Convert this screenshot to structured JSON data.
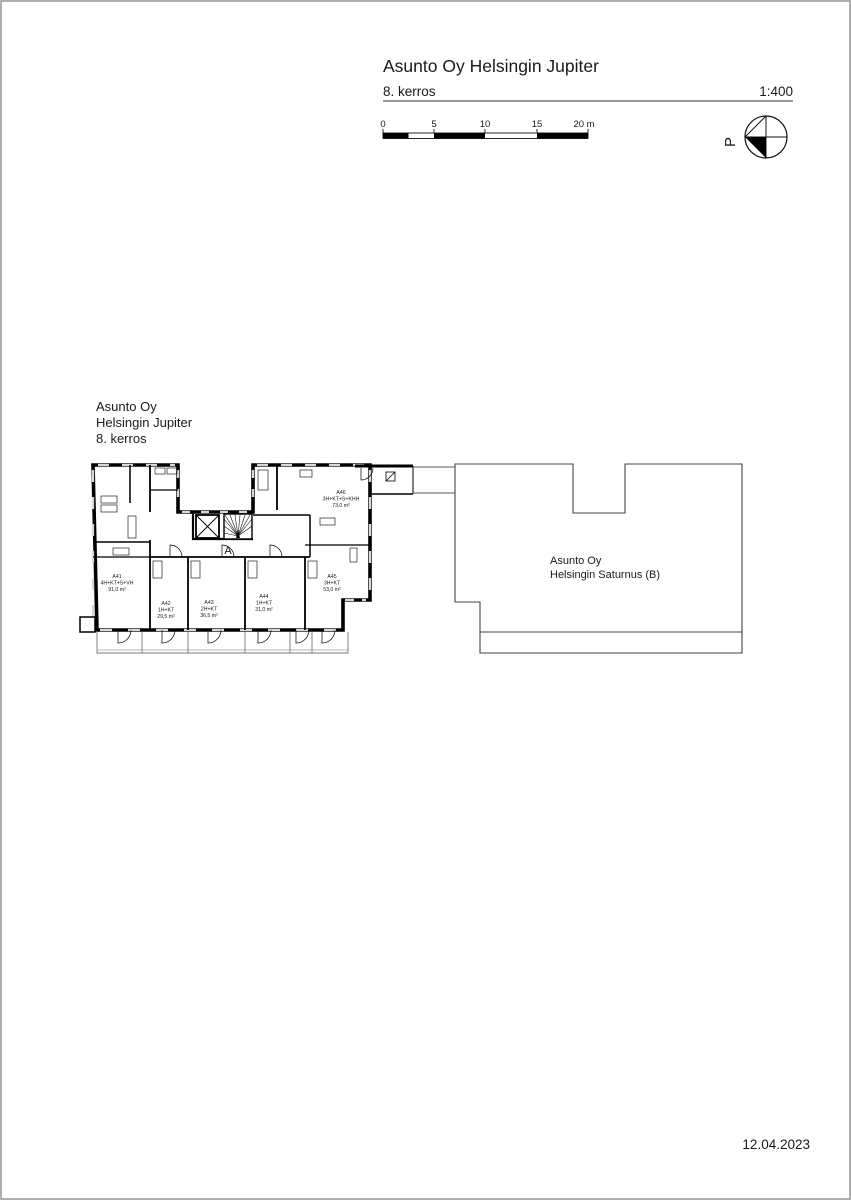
{
  "page": {
    "date": "12.04.2023",
    "border_color": "#9a9a9a",
    "background": "#ffffff"
  },
  "header": {
    "title": "Asunto Oy Helsingin Jupiter",
    "floor": "8. kerros",
    "scale": "1:400"
  },
  "scale_bar": {
    "tick_labels": [
      "0",
      "5",
      "10",
      "15",
      "20 m"
    ],
    "length_m": 20,
    "segments": [
      {
        "from_m": 0,
        "to_m": 2.5,
        "fill": "black"
      },
      {
        "from_m": 2.5,
        "to_m": 5,
        "fill": "white"
      },
      {
        "from_m": 5,
        "to_m": 10,
        "fill": "black"
      },
      {
        "from_m": 10,
        "to_m": 15,
        "fill": "white"
      },
      {
        "from_m": 15,
        "to_m": 20,
        "fill": "black"
      }
    ]
  },
  "compass": {
    "label": "P",
    "points": "left"
  },
  "plan_label": {
    "line1": "Asunto Oy",
    "line2": "Helsingin Jupiter",
    "line3": "8. kerros"
  },
  "stair_core": {
    "label": "A"
  },
  "apartments": [
    {
      "id": "A41",
      "type": "4H+KT+S+VH",
      "area": "91,0 m²"
    },
    {
      "id": "A42",
      "type": "1H+KT",
      "area": "29,5 m²"
    },
    {
      "id": "A43",
      "type": "2H+KT",
      "area": "36,5 m²"
    },
    {
      "id": "A44",
      "type": "1H+KT",
      "area": "31,0 m²"
    },
    {
      "id": "A45",
      "type": "3H+KT",
      "area": "53,0 m²"
    },
    {
      "id": "A46",
      "type": "3H+KT+S+KHH",
      "area": "73,0 m²"
    }
  ],
  "neighbor_building": {
    "line1": "Asunto Oy",
    "line2": "Helsingin Saturnus (B)"
  },
  "colors": {
    "wall": "#000000",
    "window": "#d8d8d8",
    "thin_line": "#555555",
    "balcony_rail": "#777777"
  }
}
